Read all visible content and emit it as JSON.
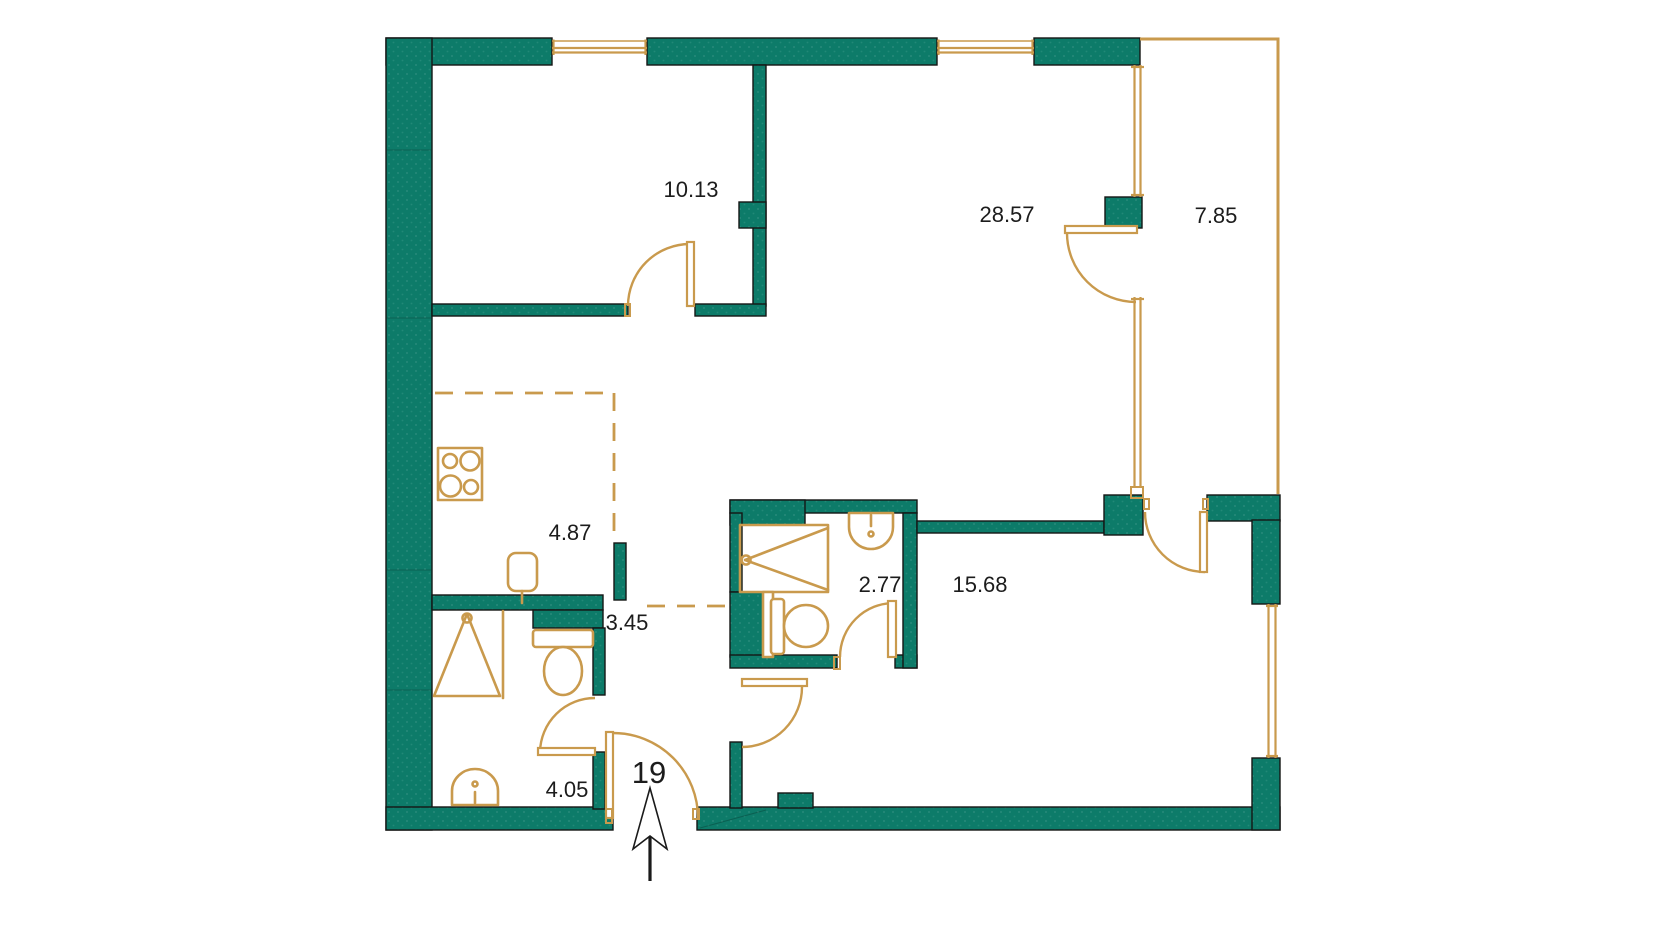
{
  "title": "apartment-floor-plan",
  "colors": {
    "wall": "#0D7B69",
    "wall_outline": "#141614",
    "accent": "#C99A4D",
    "text": "#1C1C1C",
    "background": "#FFFFFF"
  },
  "rooms": [
    {
      "id": "bedroom",
      "area": "10.13"
    },
    {
      "id": "living-room",
      "area": "28.57"
    },
    {
      "id": "balcony",
      "area": "7.85"
    },
    {
      "id": "kitchen",
      "area": "4.87"
    },
    {
      "id": "hallway",
      "area": "3.45"
    },
    {
      "id": "shower-room",
      "area": "2.77"
    },
    {
      "id": "bedroom-2",
      "area": "15.68"
    },
    {
      "id": "bathroom",
      "area": "4.05"
    }
  ],
  "entrance": {
    "label": "19"
  }
}
